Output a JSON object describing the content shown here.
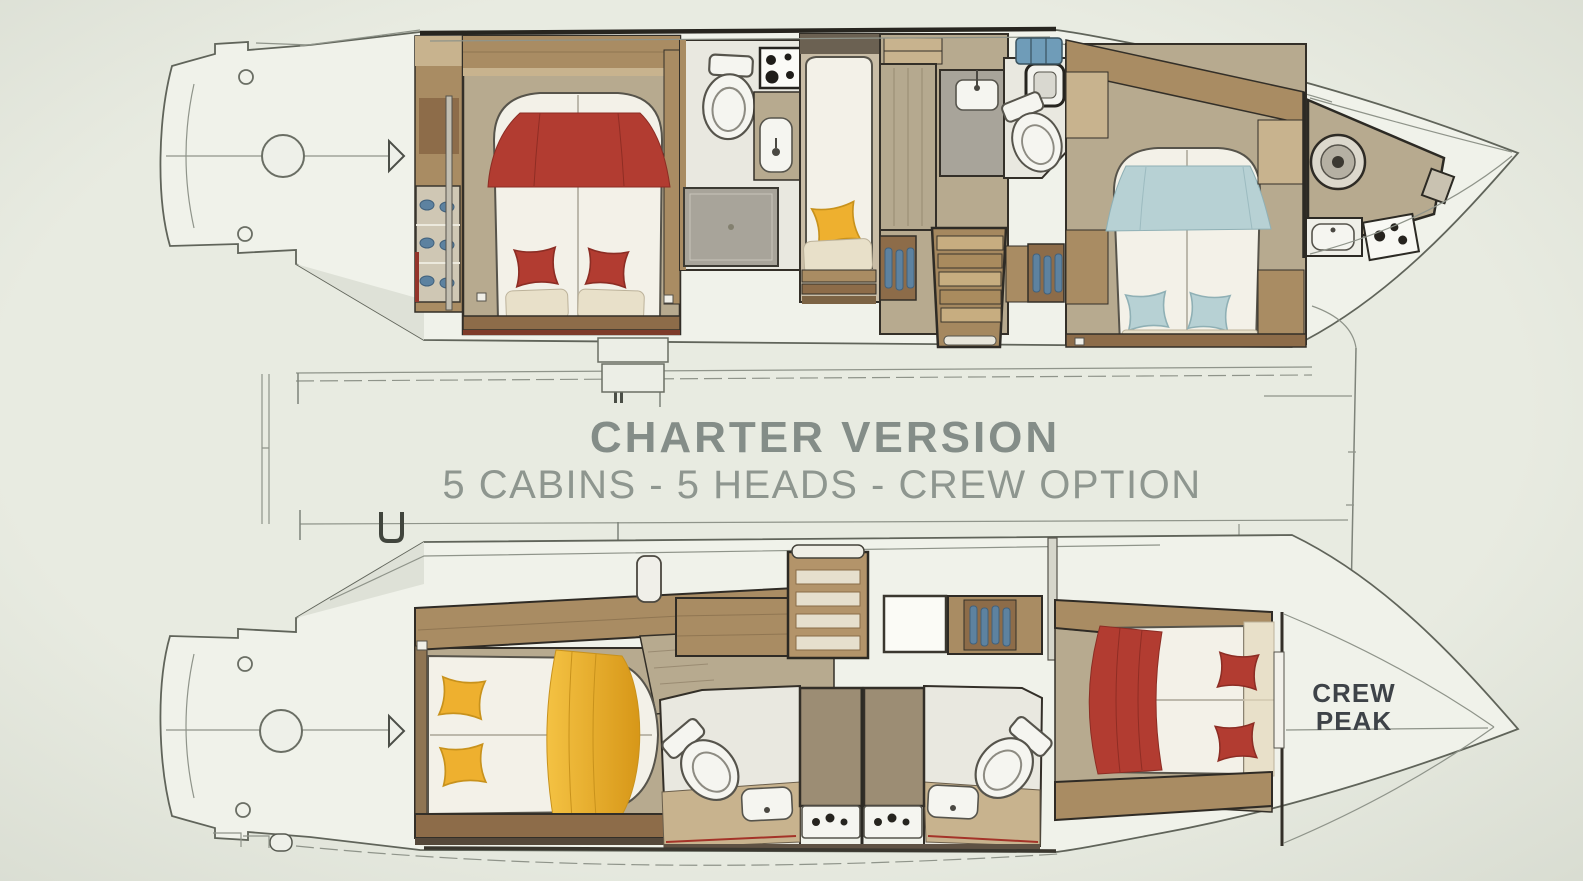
{
  "center_label": {
    "title": "CHARTER VERSION",
    "subtitle": "5 CABINS - 5 HEADS - CREW OPTION"
  },
  "bow_label": {
    "line1": "CREW",
    "line2": "PEAK"
  },
  "colors": {
    "background": "#e8ebe1",
    "bg_edge": "#d7dbd0",
    "hull_fill": "#f0f2ea",
    "hull_outline": "#60645a",
    "thin_line": "#8f948a",
    "dark_wall": "#332f28",
    "wood_dark": "#8d6c49",
    "wood_mid": "#a98c63",
    "wood_light": "#c8b38e",
    "floor_tan": "#b7aa8f",
    "floor_white": "#e9e8e0",
    "shower_gray": "#a8a49a",
    "mattress": "#f3f1e8",
    "cushion_cream": "#e8e0c9",
    "textile_red": "#b23c31",
    "textile_red_dark": "#8c2d24",
    "textile_yellow": "#eeb02f",
    "textile_yellow_dark": "#c8921c",
    "textile_blue": "#b7d1d4",
    "textile_blue_dark": "#8fb0b5",
    "storage_blue": "#5d82a0",
    "fixture_white": "#f5f5f0",
    "title_text": "#848d88",
    "subtitle_text": "#8e968f",
    "crew_peak_text": "#3e4348",
    "liferaft_blue": "#6f9cb8"
  }
}
